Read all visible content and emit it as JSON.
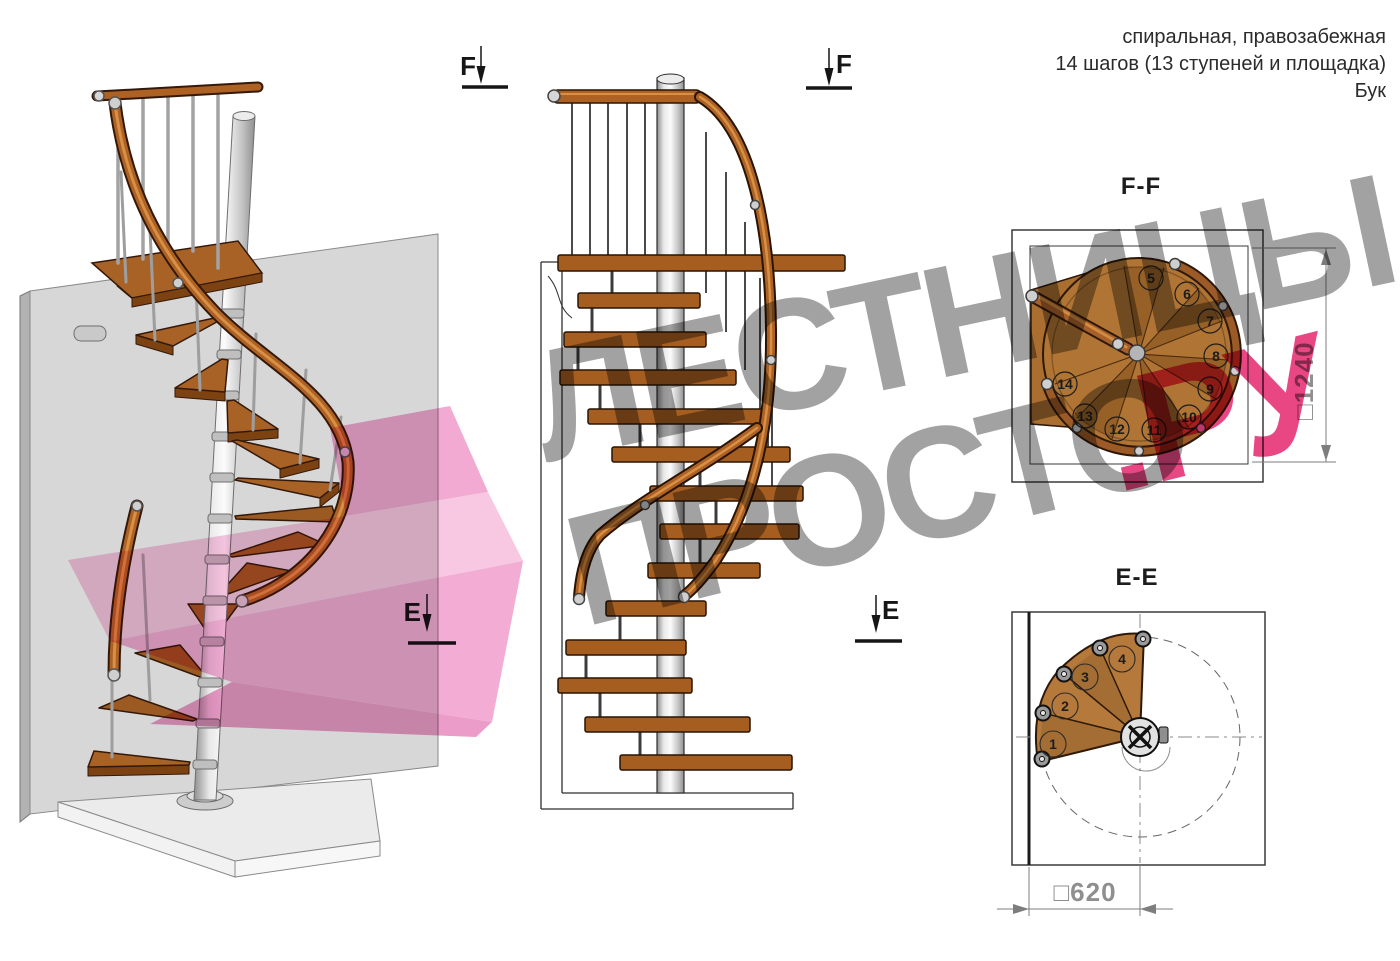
{
  "annotation": {
    "line1": "спиральная, правозабежная",
    "line2": "14 шагов (13 ступеней и площадка)",
    "line3": "Бук"
  },
  "markers": {
    "f_label": "F",
    "e_label": "E"
  },
  "views": {
    "ff": {
      "title": "F-F",
      "dim_label": "□1240",
      "steps": [
        "5",
        "6",
        "7",
        "8",
        "9",
        "10",
        "11",
        "12",
        "13",
        "14"
      ]
    },
    "ee": {
      "title": "E-E",
      "dim_label": "□620",
      "steps": [
        "1",
        "2",
        "3",
        "4"
      ]
    }
  },
  "watermark": {
    "word1": "ЛЕСТНИЦЫ",
    "word2": "ПРОСТО",
    "suffix": ".РУ"
  },
  "colors": {
    "pink": "#e84783",
    "watermark_gray": "#a2a2a2",
    "wood": "#a86226",
    "dim_gray": "#8f8f8f"
  }
}
